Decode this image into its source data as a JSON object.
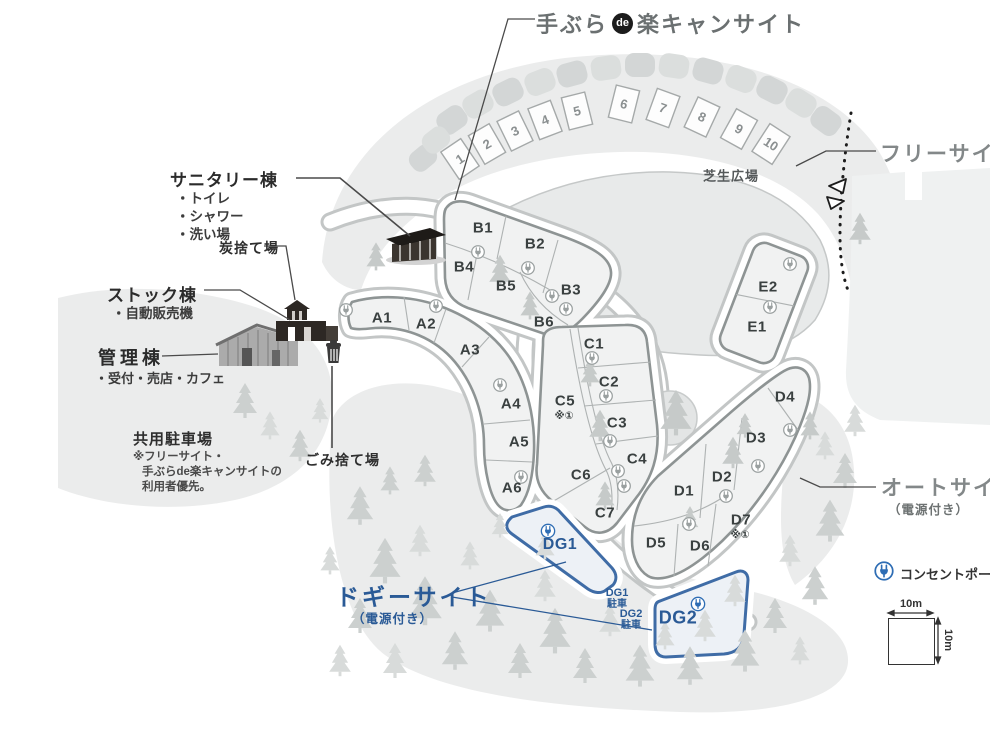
{
  "title": {
    "prefix": "手ぶら",
    "circle": "de",
    "suffix": "楽キャンサイト"
  },
  "headings": {
    "free_site": "フリーサイト",
    "auto_site": "オートサイト",
    "auto_site_note": "（電源付き）",
    "doggy_site": "ドギーサイト",
    "doggy_site_note": "（電源付き）"
  },
  "facilities": {
    "sanitary": {
      "title": "サニタリー棟",
      "items": [
        "・トイレ",
        "・シャワー",
        "・洗い場"
      ]
    },
    "stock": {
      "title": "ストック棟",
      "items": [
        "・自動販売機"
      ]
    },
    "admin": {
      "title": "管理棟",
      "items": [
        "・受付・売店・カフェ"
      ]
    },
    "shared_parking": {
      "title": "共用駐車場",
      "note": [
        "※フリーサイト・",
        "手ぶらde楽キャンサイトの",
        "利用者優先。"
      ]
    },
    "charcoal": "炭捨て場",
    "garbage": "ごみ捨て場"
  },
  "areas": {
    "lawn": "芝生広場",
    "dg1_parking": {
      "line1": "DG1",
      "line2": "駐車"
    },
    "dg2_parking": {
      "line1": "DG2",
      "line2": "駐車"
    }
  },
  "sites": {
    "numbered": [
      "1",
      "2",
      "3",
      "4",
      "5",
      "6",
      "7",
      "8",
      "9",
      "10"
    ],
    "a": [
      "A1",
      "A2",
      "A3",
      "A4",
      "A5",
      "A6"
    ],
    "b": [
      "B1",
      "B2",
      "B3",
      "B4",
      "B5",
      "B6"
    ],
    "c": [
      "C1",
      "C2",
      "C3",
      "C4",
      "C5",
      "C6",
      "C7"
    ],
    "c5_note": "※①",
    "d": [
      "D1",
      "D2",
      "D3",
      "D4",
      "D5",
      "D6",
      "D7"
    ],
    "d7_note": "※①",
    "e": [
      "E1",
      "E2"
    ],
    "dg": [
      "DG1",
      "DG2"
    ]
  },
  "legend": {
    "outlet_pole": "コンセントポール",
    "scale_width": "10m",
    "scale_height": "10m"
  },
  "colors": {
    "accent_blue": "#2a5a96",
    "plug_blue": "#2e6db4",
    "heading_gray": "#838889",
    "label_dark": "#2b2b2b",
    "terrain": "#ebecec",
    "lawn": "#e8eaea",
    "site_fill": "#f1f2f2",
    "site_border": "#8e9494",
    "tree": "#ccd0cf"
  }
}
